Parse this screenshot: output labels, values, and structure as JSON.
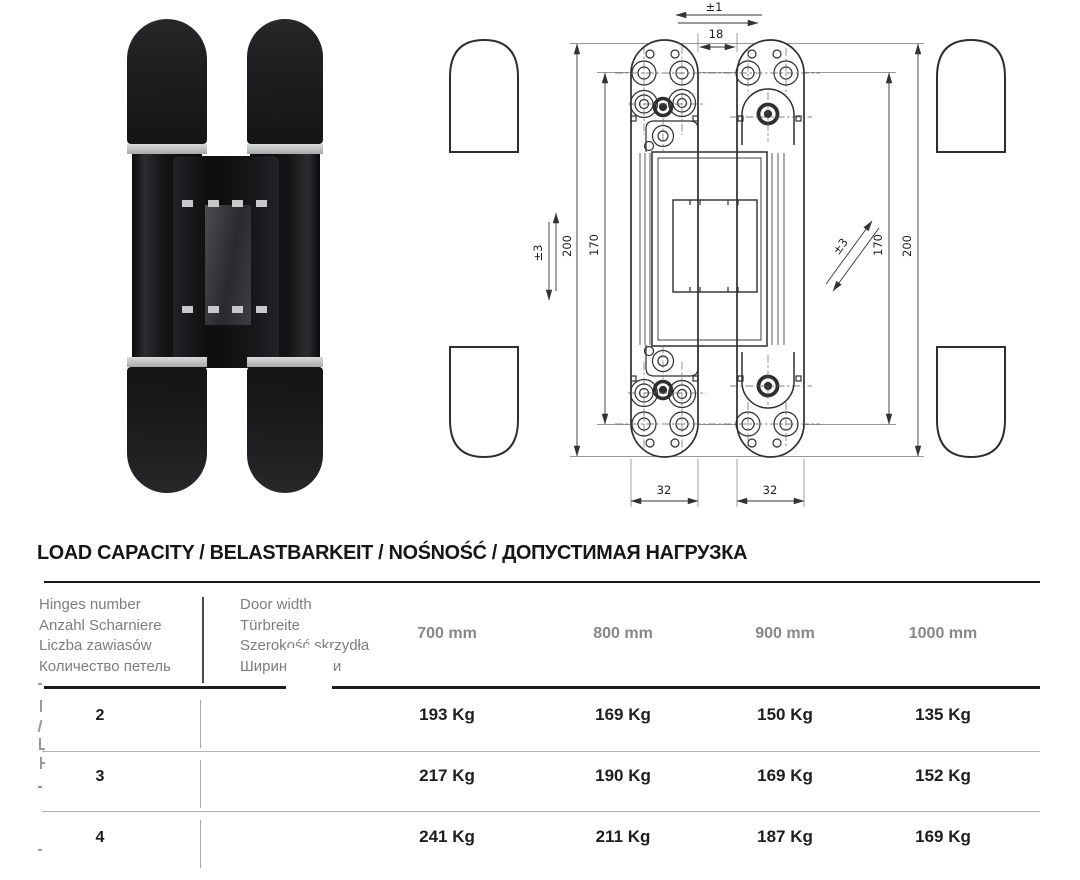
{
  "drawing": {
    "dim_labels": {
      "lateral_adjustment": "±1",
      "gap_width": "18",
      "vertical_adjustment": "±3",
      "left_total_height": "200",
      "left_screw_spacing": "170",
      "depth_adjustment": "±3",
      "right_screw_spacing": "170",
      "right_total_height": "200",
      "left_plate_width": "32",
      "right_plate_width": "32"
    }
  },
  "load_table": {
    "title": "LOAD CAPACITY / BELASTBARKEIT / NOŚNOŚĆ / ДОПУСТИМАЯ НАГРУЗКА",
    "hinges_header": [
      "Hinges number",
      "Anzahl Scharniere",
      "Liczba zawiasów",
      "Количество петель"
    ],
    "door_width_header": [
      "Door width",
      "Türbreite",
      "Szerokość skrzydła",
      "Ширина двери"
    ],
    "width_columns": [
      "700 mm",
      "800 mm",
      "900 mm",
      "1000 mm"
    ],
    "rows": [
      {
        "hinges": "2",
        "capacities": [
          "193 Kg",
          "169 Kg",
          "150 Kg",
          "135 Kg"
        ]
      },
      {
        "hinges": "3",
        "capacities": [
          "217 Kg",
          "190 Kg",
          "169 Kg",
          "152 Kg"
        ]
      },
      {
        "hinges": "4",
        "capacities": [
          "241 Kg",
          "211 Kg",
          "187 Kg",
          "169 Kg"
        ]
      }
    ]
  },
  "colors": {
    "line": "#2e2e2e",
    "header_gray": "#7d7d7d",
    "text_dark": "#1c1c1c",
    "separator": "#b5b5b5",
    "hinge_black": "#1d1d20"
  }
}
